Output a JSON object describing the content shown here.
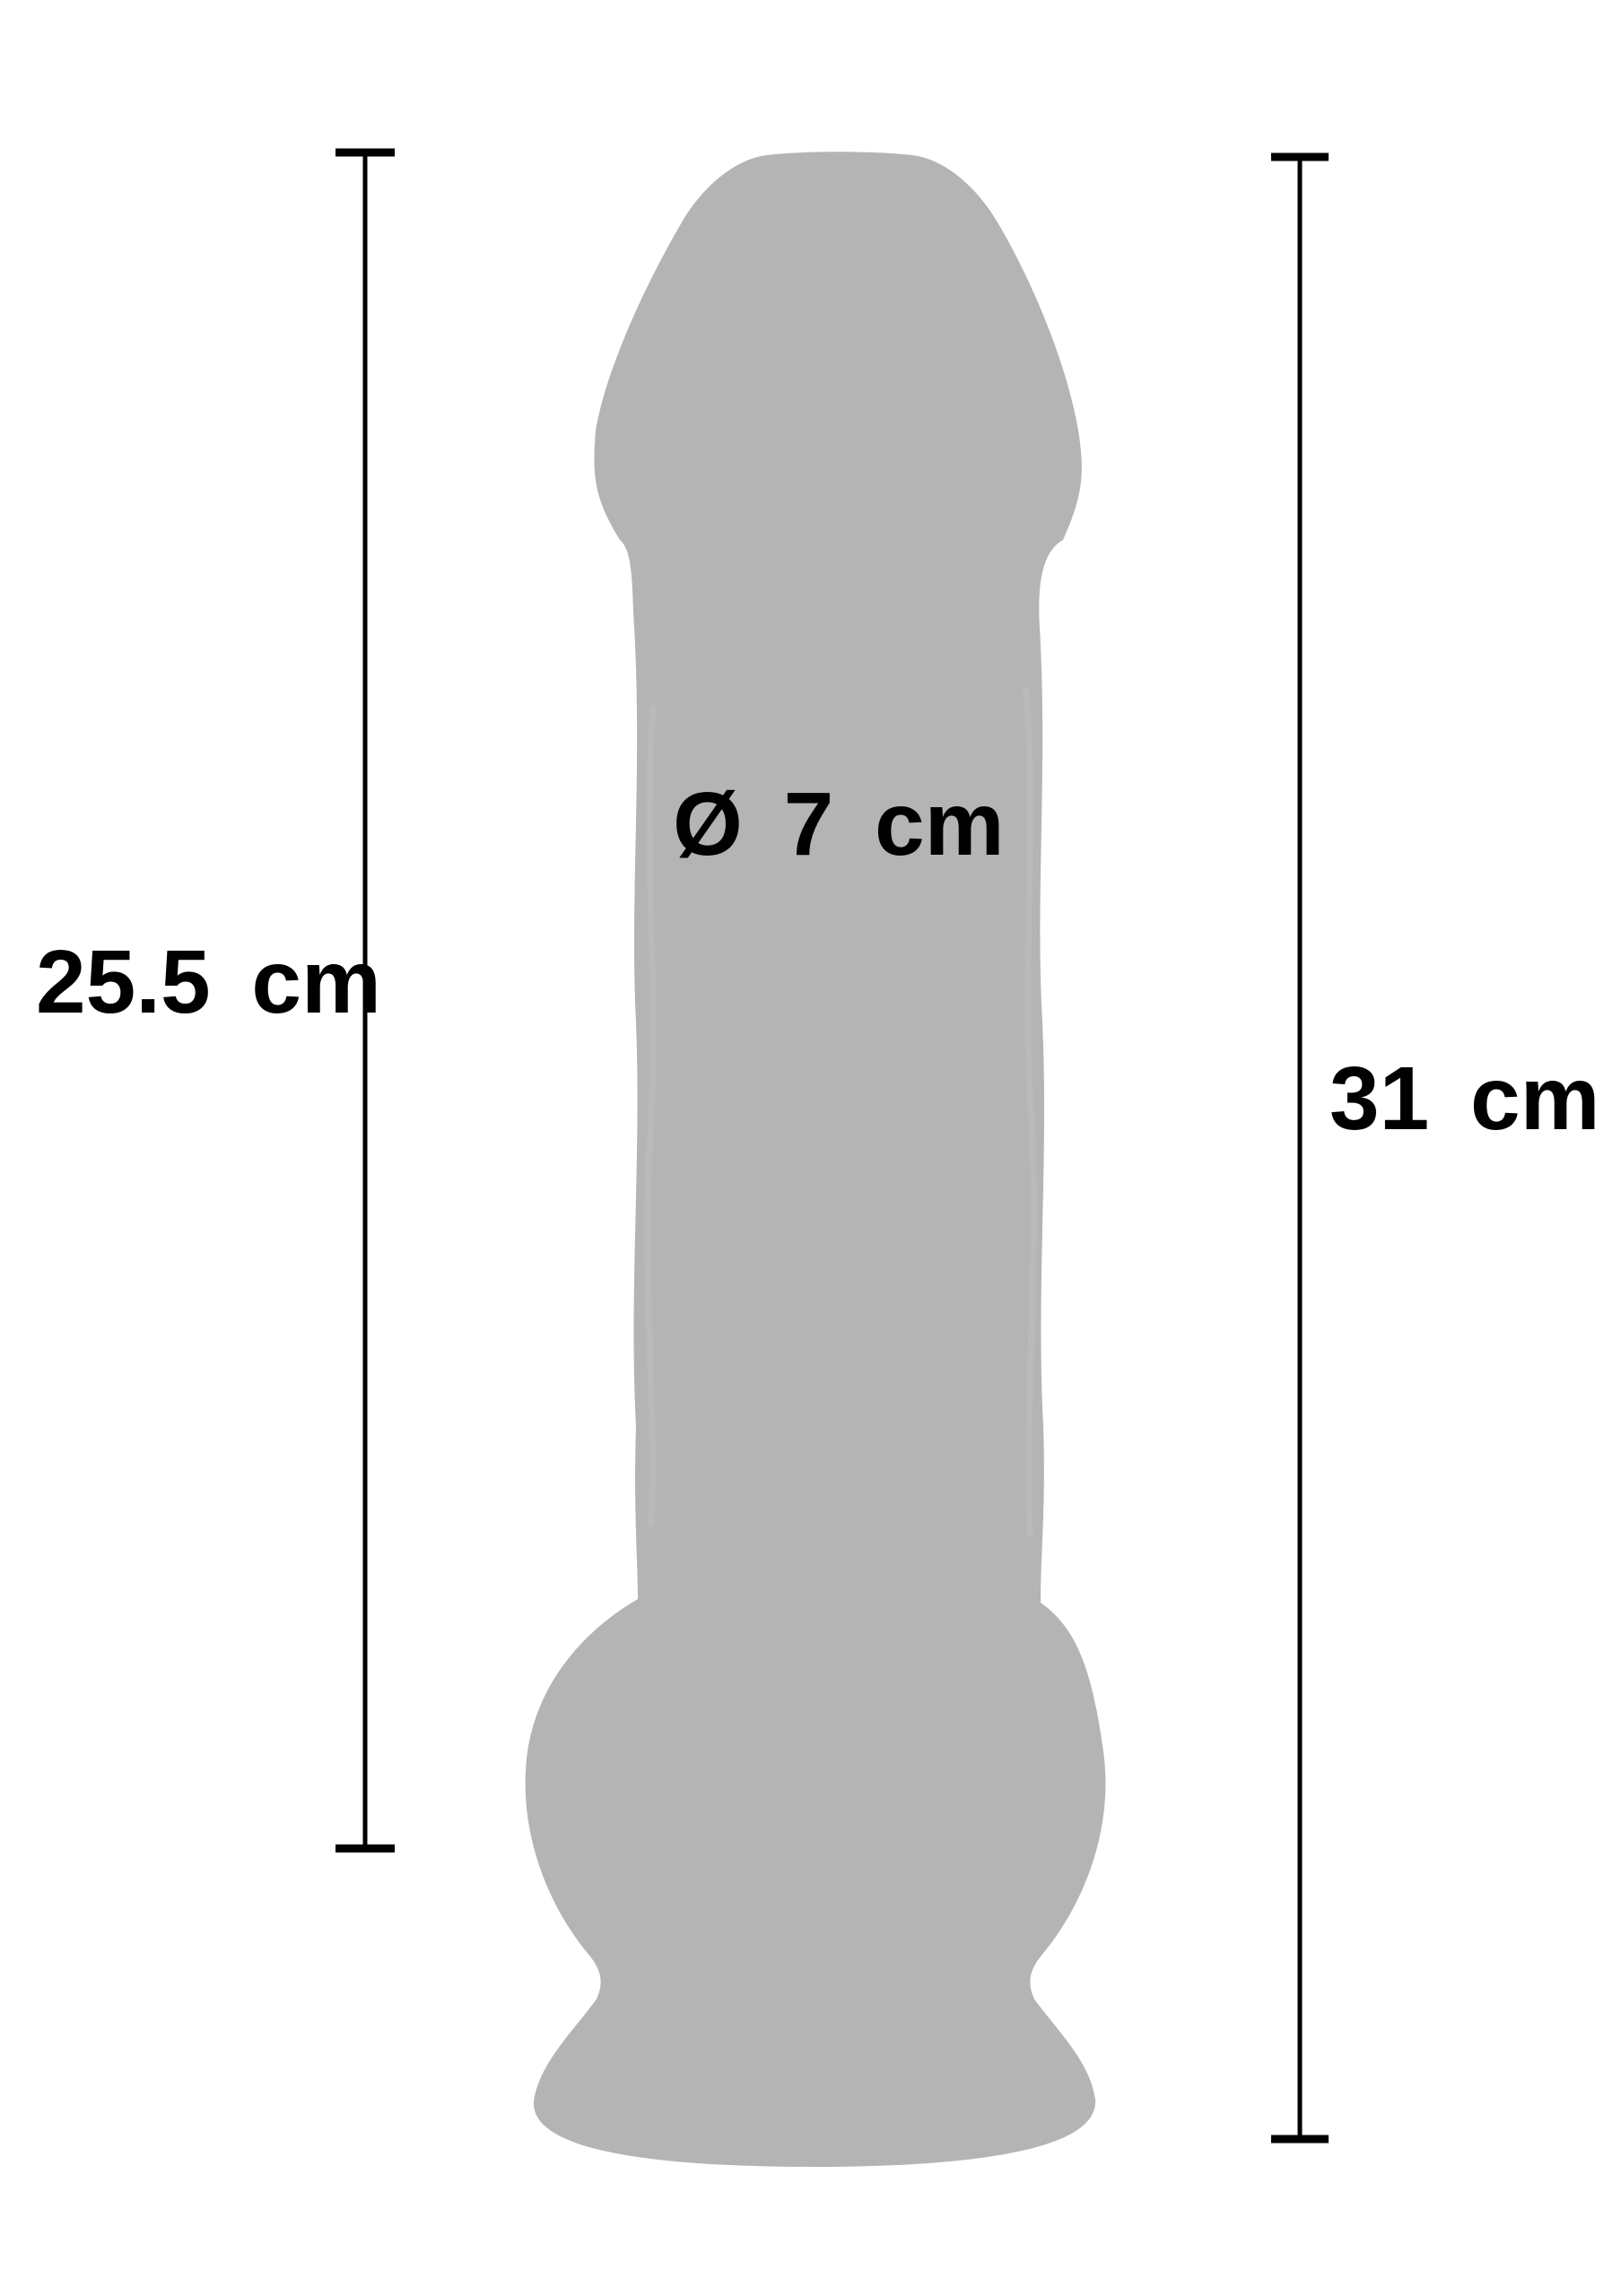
{
  "diagram": {
    "description": "product dimension silhouette diagram",
    "background_color": "#ffffff",
    "silhouette_color": "#b4b4b4",
    "line_color": "#000000",
    "text_color": "#000000",
    "labels": {
      "insertable_length": "25.5 cm",
      "total_length": "31 cm",
      "diameter": "Ø 7 cm"
    },
    "measurement_sides": {
      "insertable_length": "left",
      "total_length": "right",
      "diameter": "center-on-shaft"
    }
  }
}
